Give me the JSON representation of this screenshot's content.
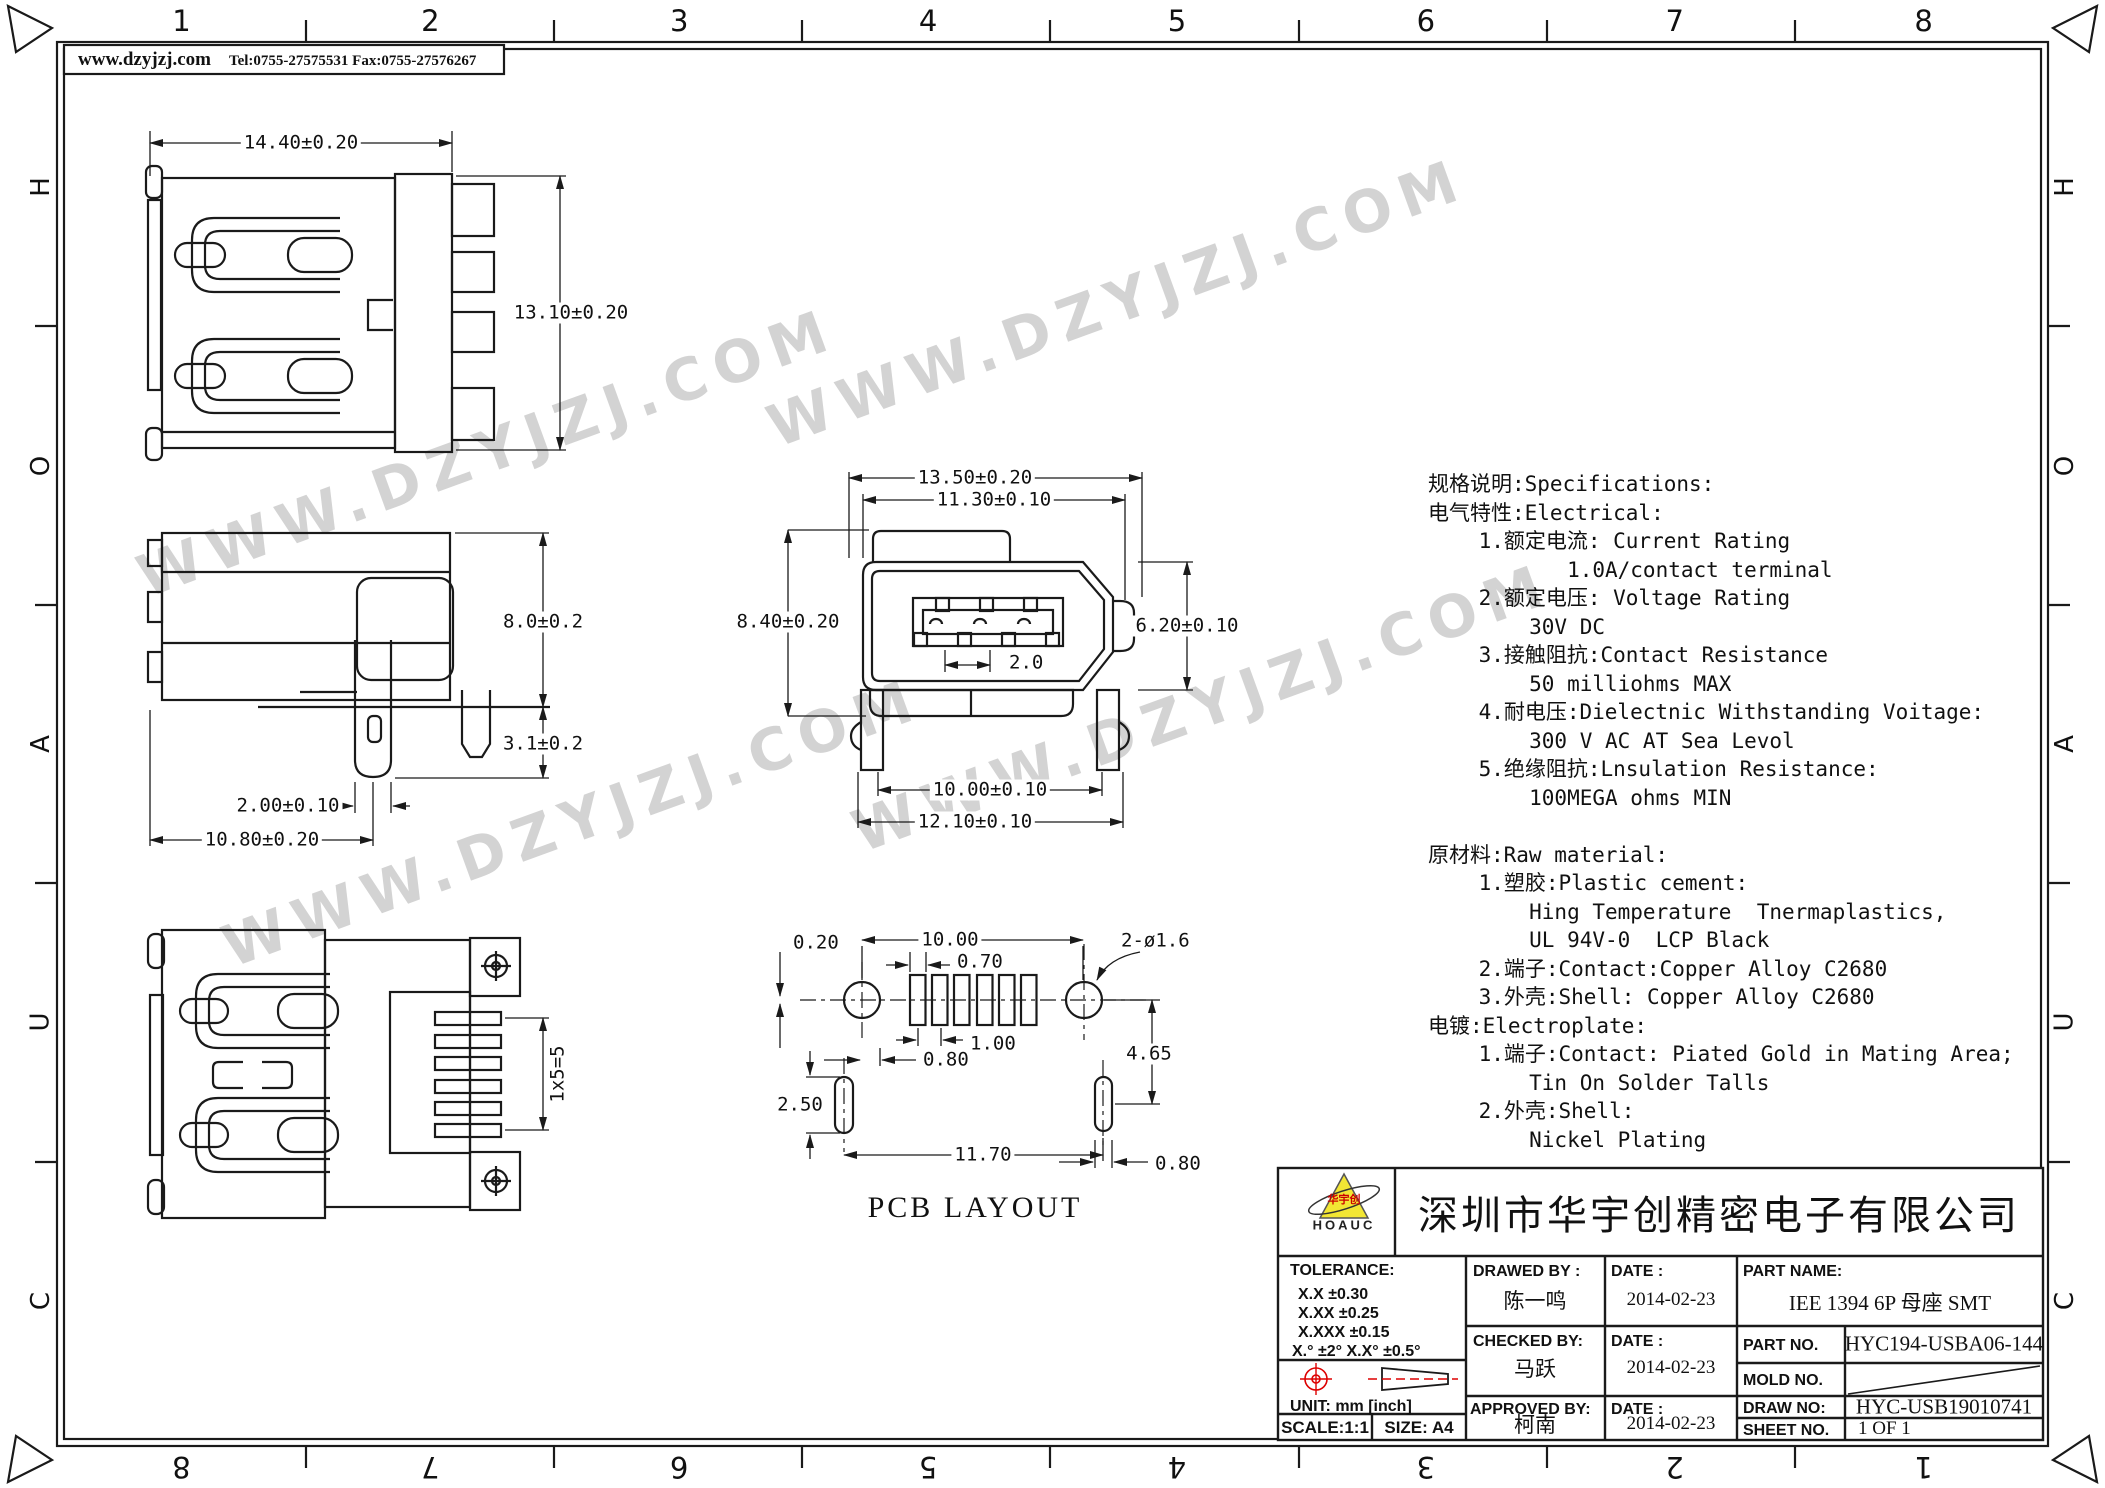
{
  "header": {
    "website": "www.dzyjzj.com",
    "contact": "Tel:0755-27575531  Fax:0755-27576267"
  },
  "frame": {
    "columns": [
      "1",
      "2",
      "3",
      "4",
      "5",
      "6",
      "7",
      "8"
    ],
    "rows": [
      "H",
      "O",
      "A",
      "U",
      "C"
    ]
  },
  "watermark": {
    "text": "WWW.DZYJZJ.COM"
  },
  "dims": {
    "v1w": "14.40±0.20",
    "v1h": "13.10±0.20",
    "v2h": "8.0±0.2",
    "v2p": "3.1±0.2",
    "v2o": "2.00±0.10",
    "v2d": "10.80±0.20",
    "v3a": "13.50±0.20",
    "v3b": "11.30±0.10",
    "v3c": "8.40±0.20",
    "v3d": "6.20±0.10",
    "v3e": "2.0",
    "v3f": "10.00±0.10",
    "v3g": "12.10±0.10",
    "v4a": "1x5=5",
    "p1": "0.20",
    "p2": "10.00",
    "p3": "0.70",
    "p4": "1.00",
    "p5": "0.80",
    "p6": "2.50",
    "p7": "11.70",
    "p8": "4.65",
    "p9": "0.80",
    "p10": "2-ø1.6",
    "pcb_title": "PCB LAYOUT"
  },
  "specs": {
    "lines": [
      "规格说明:Specifications:",
      "电气特性:Electrical:",
      "    1.额定电流: Current Rating",
      "           1.0A/contact terminal",
      "    2.额定电压: Voltage Rating",
      "        30V DC",
      "    3.接触阻抗:Contact Resistance",
      "        50 milliohms MAX",
      "    4.耐电压:Dielectnic Withstanding Voitage:",
      "        300 V AC AT Sea Levol",
      "    5.绝缘阻抗:Lnsulation Resistance:",
      "        100MEGA ohms MIN",
      "",
      "原材料:Raw material:",
      "    1.塑胶:Plastic cement:",
      "        Hing Temperature  Tnermaplastics,",
      "        UL 94V-0  LCP Black",
      "    2.端子:Contact:Copper Alloy C2680",
      "    3.外壳:Shell: Copper Alloy C2680",
      "电镀:Electroplate:",
      "    1.端子:Contact: Piated Gold in Mating Area;",
      "        Tin On Solder Talls",
      "    2.外壳:Shell:",
      "        Nickel Plating"
    ]
  },
  "titleblock": {
    "company": "深圳市华宇创精密电子有限公司",
    "logo_cn": "华宇创",
    "logo_en": "HOAUC",
    "tolerance_label": "TOLERANCE:",
    "tol1": "X.X    ±0.30",
    "tol2": "X.XX   ±0.25",
    "tol3": "X.XXX ±0.15",
    "angles": "X.°  ±2°       X.X°  ±0.5°",
    "unit": "UNIT:  mm  [inch]",
    "scale": "SCALE:1:1",
    "size": "SIZE:  A4",
    "drawed_by_label": "DRAWED BY :",
    "drawed_by": "陈一鸣",
    "checked_by_label": "CHECKED BY:",
    "checked_by": "马跃",
    "approved_by_label": "APPROVED BY:",
    "approved_by": "柯南",
    "date_label": "DATE :",
    "date1": "2014-02-23",
    "date2": "2014-02-23",
    "date3": "2014-02-23",
    "part_name_label": "PART NAME:",
    "part_name": "IEE 1394 6P 母座 SMT",
    "part_no_label": "PART NO.",
    "part_no": "HYC194-USBA06-144",
    "mold_no_label": "MOLD NO.",
    "draw_no_label": "DRAW NO:",
    "draw_no": "HYC-USB19010741",
    "sheet_no_label": "SHEET NO.",
    "sheet_no": "1 OF 1"
  }
}
